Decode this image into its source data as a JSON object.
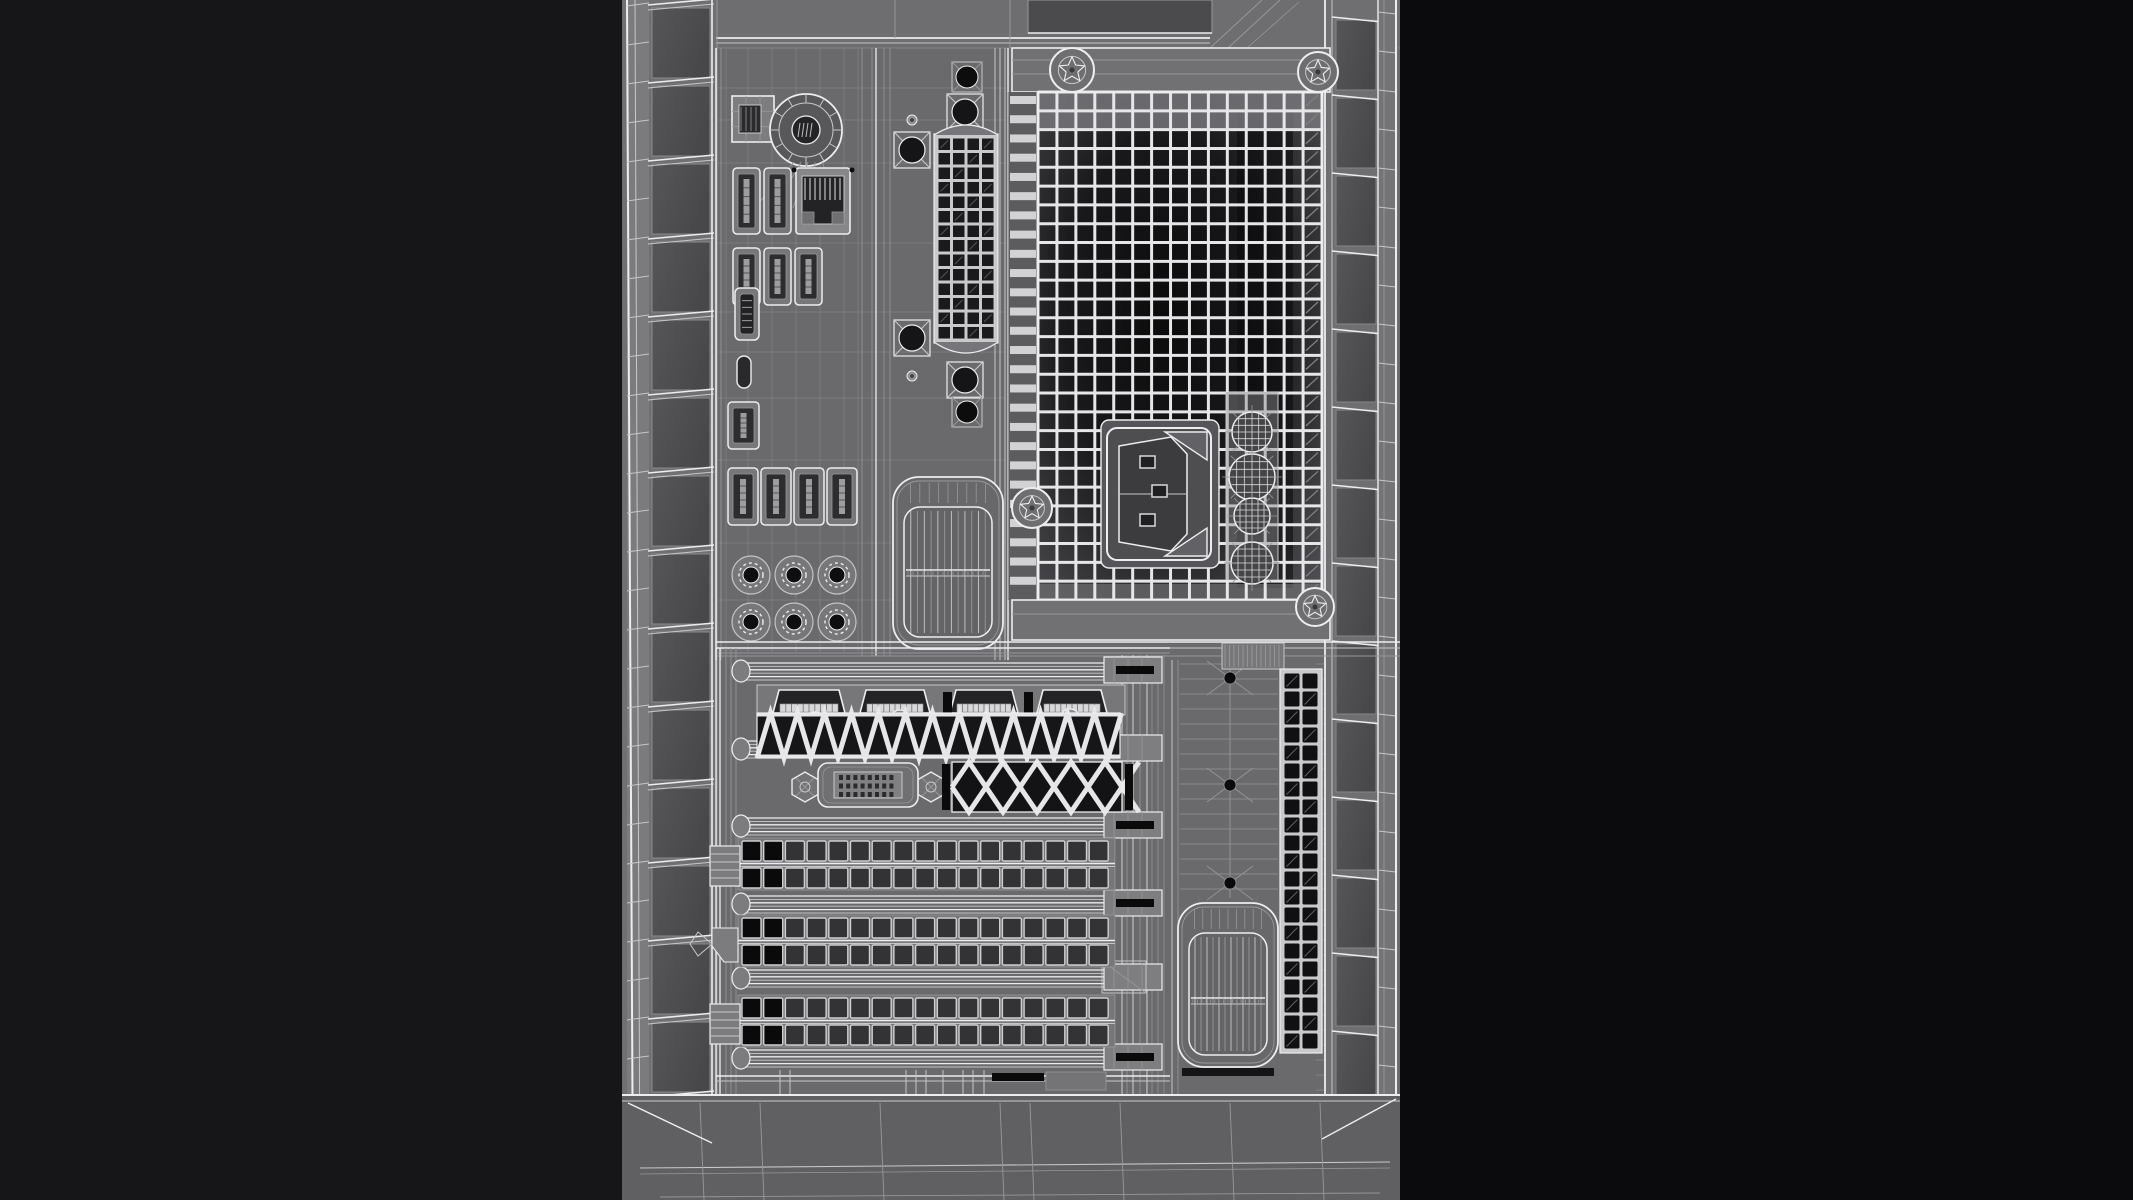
{
  "scene": {
    "description": "Wireframe 3D render of the rear panel of a desktop computer tower case",
    "render_mode": "wireframe"
  },
  "colors": {
    "bg_left": "#161618",
    "bg_right": "#0b0b0d",
    "panel": "#6a6a6d",
    "panel_light": "#78787b",
    "panel_dark": "#58585b",
    "panel_darker": "#4b4b4e",
    "apron": "#606063",
    "cell": "#565659",
    "cell_shadow": "#48484b",
    "line_bright": "#ededef",
    "line_mid": "#c7c7ca",
    "line_dim": "#97979a",
    "hole_dark": "#1a1a1c",
    "hole_black": "#0a0a0b",
    "hole_gray": "#333336",
    "lattice": "#e6e6e8",
    "grid_core": "#0b0b0c",
    "grid_edge": "#55555a"
  },
  "canvas": {
    "width": 2133,
    "height": 1200
  },
  "tower": {
    "x": 622,
    "y": 0,
    "w": 778,
    "h": 1200
  },
  "top_zone": {
    "h": 48,
    "recess": {
      "x": 1028,
      "y": 0,
      "w": 184,
      "h": 33
    }
  },
  "apron": {
    "y": 1095
  },
  "left_rail": {
    "edge_x": 627,
    "cells_x": 652,
    "cell_w": 58,
    "right_x": 712,
    "cell_pitch": 78,
    "cells": 15,
    "strip_w": 22
  },
  "right_rail": {
    "x0": 1325,
    "cells_x": 1336,
    "cell_w": 40,
    "strip_x": 1378,
    "strip_w": 18,
    "edge_x": 1396,
    "cell_pitch": 78,
    "cells": 15
  },
  "io_panel": {
    "x": 716,
    "y": 48,
    "w": 292,
    "h": 612,
    "ps2_port": {
      "x": 732,
      "y": 96,
      "w": 42,
      "h": 46
    },
    "round_port": {
      "cx": 806,
      "cy": 130,
      "r": 36
    },
    "usb_ports": [
      {
        "x": 733,
        "y": 168,
        "w": 27,
        "h": 66
      },
      {
        "x": 764,
        "y": 168,
        "w": 27,
        "h": 66
      },
      {
        "x": 733,
        "y": 248,
        "w": 27,
        "h": 57
      },
      {
        "x": 764,
        "y": 248,
        "w": 27,
        "h": 57
      },
      {
        "x": 795,
        "y": 248,
        "w": 27,
        "h": 57
      },
      {
        "x": 728,
        "y": 402,
        "w": 31,
        "h": 47
      },
      {
        "x": 728,
        "y": 468,
        "w": 30,
        "h": 57
      },
      {
        "x": 761,
        "y": 468,
        "w": 30,
        "h": 57
      },
      {
        "x": 794,
        "y": 468,
        "w": 30,
        "h": 57
      },
      {
        "x": 827,
        "y": 468,
        "w": 30,
        "h": 57
      }
    ],
    "ethernet_port": {
      "x": 796,
      "y": 168,
      "w": 54,
      "h": 66
    },
    "hdmi_port": {
      "x": 735,
      "y": 288,
      "w": 24,
      "h": 52
    },
    "oval_slot": {
      "x": 737,
      "y": 356,
      "w": 14,
      "h": 32
    },
    "audio_jacks": {
      "r": 19,
      "centers": [
        [
          751,
          575
        ],
        [
          794,
          575
        ],
        [
          837,
          575
        ],
        [
          751,
          622
        ],
        [
          794,
          622
        ],
        [
          837,
          622
        ]
      ]
    },
    "grille": {
      "x": 893,
      "y": 477,
      "w": 110,
      "h": 172,
      "band_y": 570
    }
  },
  "center_rail": {
    "x": 860,
    "w": 148,
    "vent_strip": {
      "x": 937,
      "y": 137,
      "cols": 4,
      "rows": 14,
      "pitch": 14.5,
      "cell": 11.5
    },
    "x_screws": [
      [
        912,
        150
      ],
      [
        912,
        338
      ],
      [
        965,
        112
      ],
      [
        965,
        380
      ]
    ],
    "dot_screws": [
      [
        912,
        120
      ],
      [
        912,
        376
      ]
    ],
    "black_screws": [
      [
        967,
        77
      ],
      [
        967,
        412
      ]
    ]
  },
  "psu": {
    "bar_top": {
      "x": 1012,
      "y": 48,
      "w": 318,
      "h": 44
    },
    "bar_bottom": {
      "x": 1012,
      "y": 600,
      "w": 318,
      "h": 40
    },
    "slat_strip": {
      "x": 1008,
      "y": 92,
      "w": 30,
      "h": 508,
      "slats": 26
    },
    "vent_grid": {
      "x": 1038,
      "y": 92,
      "w": 284,
      "h": 508,
      "cols": 15,
      "rows": 27,
      "dark_band_x": 1237,
      "dark_band_w": 56
    },
    "power_inlet": {
      "x": 1107,
      "y": 428,
      "w": 104,
      "h": 132
    },
    "mesh_vents": {
      "cx": 1252,
      "items": [
        [
          432,
          20
        ],
        [
          477,
          23
        ],
        [
          516,
          18
        ],
        [
          563,
          21
        ]
      ]
    },
    "fan_emblems": [
      [
        1072,
        70,
        22
      ],
      [
        1318,
        72,
        20
      ],
      [
        1032,
        508,
        20
      ],
      [
        1315,
        607,
        19
      ]
    ],
    "divider_band_y": 640
  },
  "pci": {
    "x": 716,
    "y": 648,
    "w": 454,
    "h": 447,
    "display_ports": {
      "y": 687,
      "ports": [
        [
          773,
          72
        ],
        [
          860,
          70
        ],
        [
          950,
          68
        ],
        [
          1037,
          70
        ]
      ],
      "separators": [
        943,
        1024
      ],
      "screws": [
        [
          815,
          722
        ],
        [
          900,
          720
        ],
        [
          1070,
          719
        ]
      ]
    },
    "zigzag": {
      "x0": 757,
      "x1": 1120,
      "y": 713,
      "h": 45,
      "step": 27
    },
    "dvi_port": {
      "x": 818,
      "y": 763,
      "w": 100,
      "h": 44,
      "pin_rows": 3,
      "pin_cols": 8
    },
    "hex_screws": [
      [
        805,
        787
      ],
      [
        931,
        787
      ]
    ],
    "diamond_vent": {
      "x": 952,
      "y": 762,
      "w": 170,
      "h": 50,
      "diamonds": 5
    },
    "rails": [
      {
        "y": 660,
        "slot": true
      },
      {
        "y": 738,
        "slot": false
      },
      {
        "y": 815,
        "slot": true
      },
      {
        "y": 893,
        "slot": true
      },
      {
        "y": 967,
        "slot": false,
        "bracket": true
      },
      {
        "y": 1047,
        "slot": true
      }
    ],
    "blank_covers": {
      "rows_y": [
        840,
        917,
        997
      ],
      "x": 742,
      "cols": 17,
      "pitch": 21.7,
      "cell_w": 19,
      "cell_h": 20,
      "black_cells": 2
    }
  },
  "right_panel": {
    "x": 1170,
    "y": 660,
    "w": 155,
    "h": 435,
    "dots": {
      "x": 1230,
      "ys": [
        678,
        785,
        883
      ]
    },
    "vent_strip": {
      "x": 1283,
      "y": 672,
      "cols": 2,
      "rows": 21,
      "pitch": 18,
      "cell": 15
    },
    "grille": {
      "x": 1178,
      "y": 903,
      "w": 100,
      "h": 164,
      "band_y": 998
    },
    "slat_band": {
      "x": 1222,
      "y": 643,
      "w": 62,
      "h": 26
    }
  }
}
